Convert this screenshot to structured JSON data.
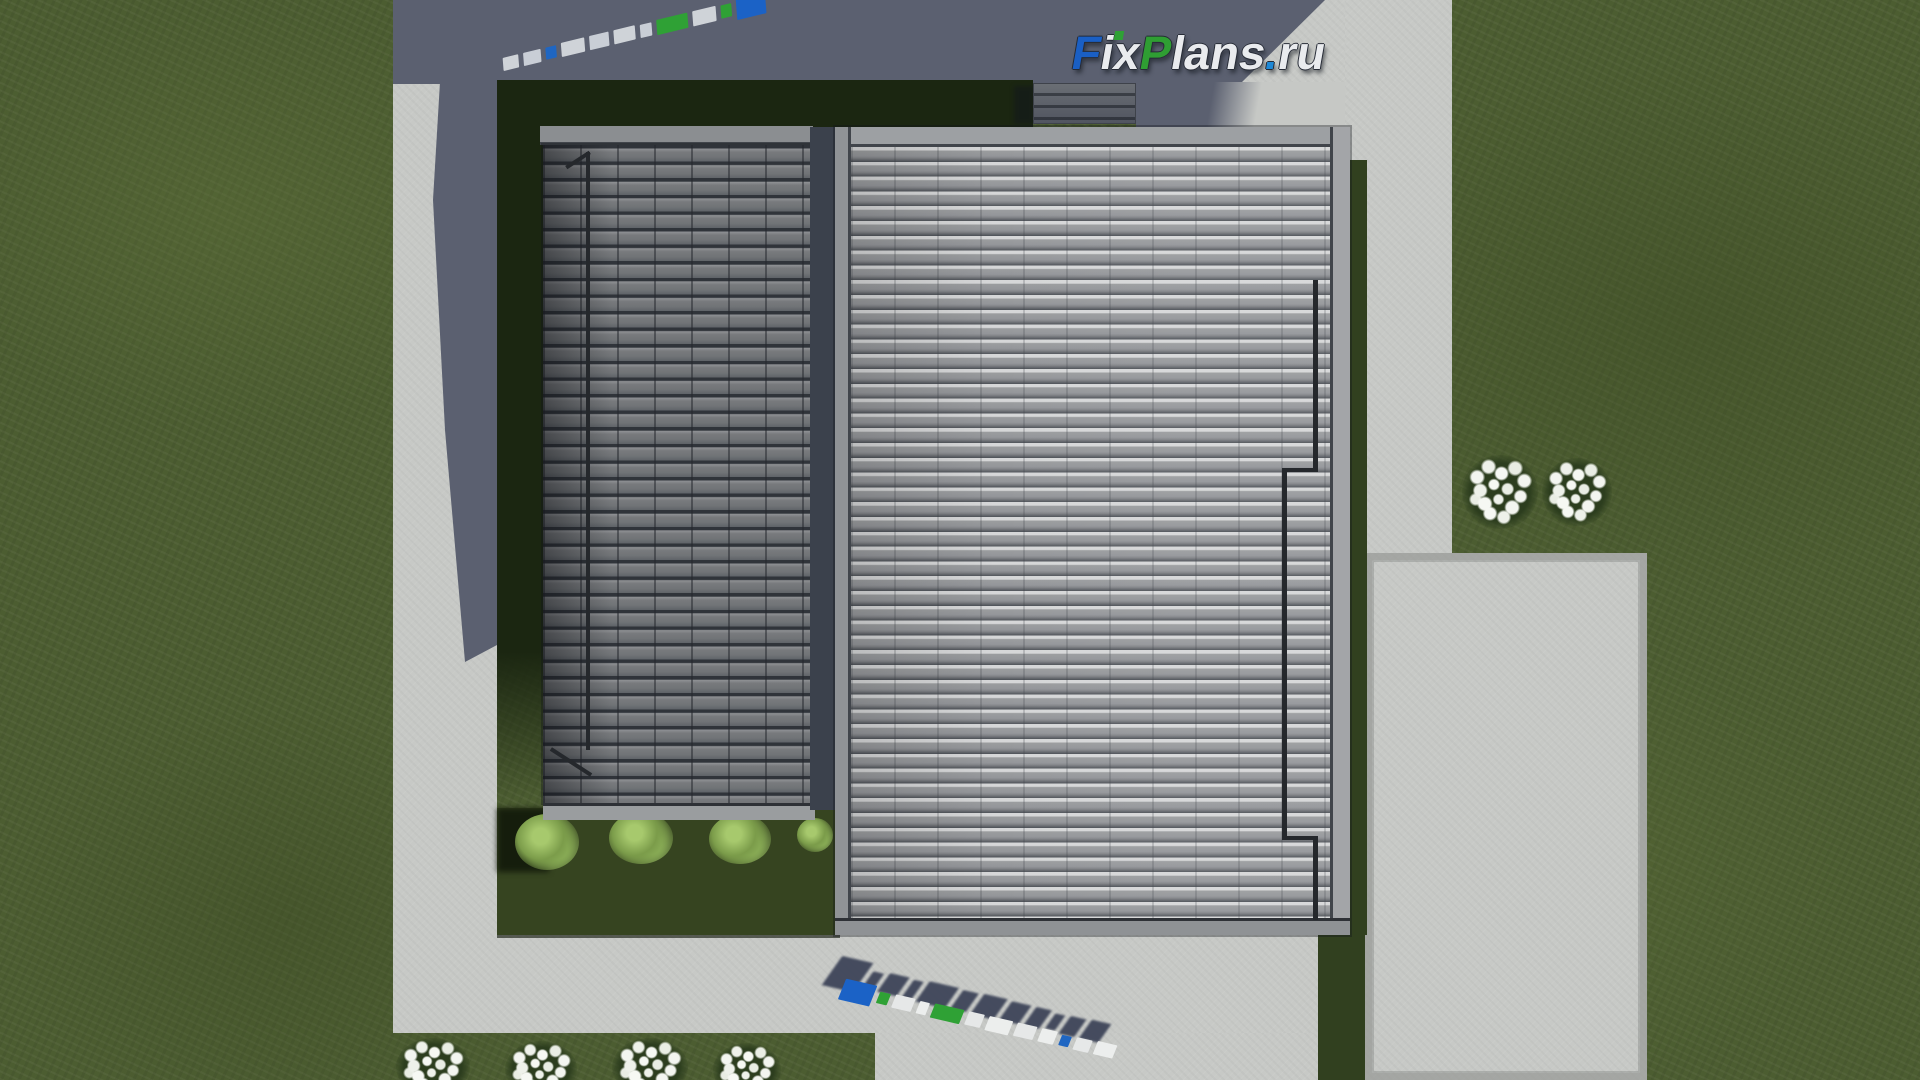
{
  "logo": {
    "text": "FixPlans.ru",
    "segments": [
      {
        "text": "F",
        "color": "#1a5fc4"
      },
      {
        "text": "ix",
        "color": "#e9ebee"
      },
      {
        "text": "P",
        "color": "#2f9e33"
      },
      {
        "text": "lans",
        "color": "#e9ebee"
      },
      {
        "text": ".",
        "color": "#1e88d6"
      },
      {
        "text": "ru",
        "color": "#e9ebee"
      }
    ],
    "i_dot_color": "#2fa135"
  },
  "colors": {
    "grass": "#4c5d31",
    "grass_shadowed": "#1b2611",
    "grass_strip": "#31401f",
    "courtyard_grass": "#364420",
    "concrete_lit": "#c7c9c6",
    "concrete_shadow": "#5b6070",
    "roof_left_tile": "#717477",
    "roof_right_tile": "#9b9d9f",
    "roof_valley": "#3b414c",
    "roof_parapet": "#9da0a3",
    "chimney": "#565a60",
    "drainpipe": "#25282c"
  },
  "ground_watermarks": {
    "text": "FixPlans.ru",
    "top": {
      "rotation_deg": -13.5,
      "blocks": [
        {
          "w": 16,
          "h": 13,
          "c": "#cfd3d8"
        },
        {
          "w": 18,
          "h": 13,
          "c": "#c9ced6"
        },
        {
          "w": 11,
          "h": 12,
          "c": "#1f66c2"
        },
        {
          "w": 24,
          "h": 14,
          "c": "#cfd3d8"
        },
        {
          "w": 20,
          "h": 14,
          "c": "#c9ced6"
        },
        {
          "w": 22,
          "h": 14,
          "c": "#cfd3d8"
        },
        {
          "w": 12,
          "h": 13,
          "c": "#c9ced6"
        },
        {
          "w": 32,
          "h": 15,
          "c": "#2fa135"
        },
        {
          "w": 24,
          "h": 15,
          "c": "#cfd3d8"
        },
        {
          "w": 11,
          "h": 13,
          "c": "#2fa135"
        },
        {
          "w": 30,
          "h": 24,
          "c": "#1b62c6"
        }
      ]
    },
    "bottom": {
      "rotation_deg": 13,
      "shadow_color": "#3a4156",
      "blocks": [
        {
          "w": 32,
          "h": 22,
          "c": "#1b62c6"
        },
        {
          "w": 11,
          "h": 12,
          "c": "#2fa135"
        },
        {
          "w": 20,
          "h": 14,
          "c": "#e6e8e8"
        },
        {
          "w": 10,
          "h": 13,
          "c": "#eceeed"
        },
        {
          "w": 30,
          "h": 15,
          "c": "#2fa135"
        },
        {
          "w": 16,
          "h": 14,
          "c": "#e6e8e8"
        },
        {
          "w": 24,
          "h": 15,
          "c": "#eceeed"
        },
        {
          "w": 20,
          "h": 14,
          "c": "#e6e8e8"
        },
        {
          "w": 16,
          "h": 14,
          "c": "#eceeed"
        },
        {
          "w": 10,
          "h": 11,
          "c": "#1f66c2"
        },
        {
          "w": 16,
          "h": 13,
          "c": "#e6e8e8"
        },
        {
          "w": 20,
          "h": 14,
          "c": "#eceeed"
        }
      ]
    }
  }
}
